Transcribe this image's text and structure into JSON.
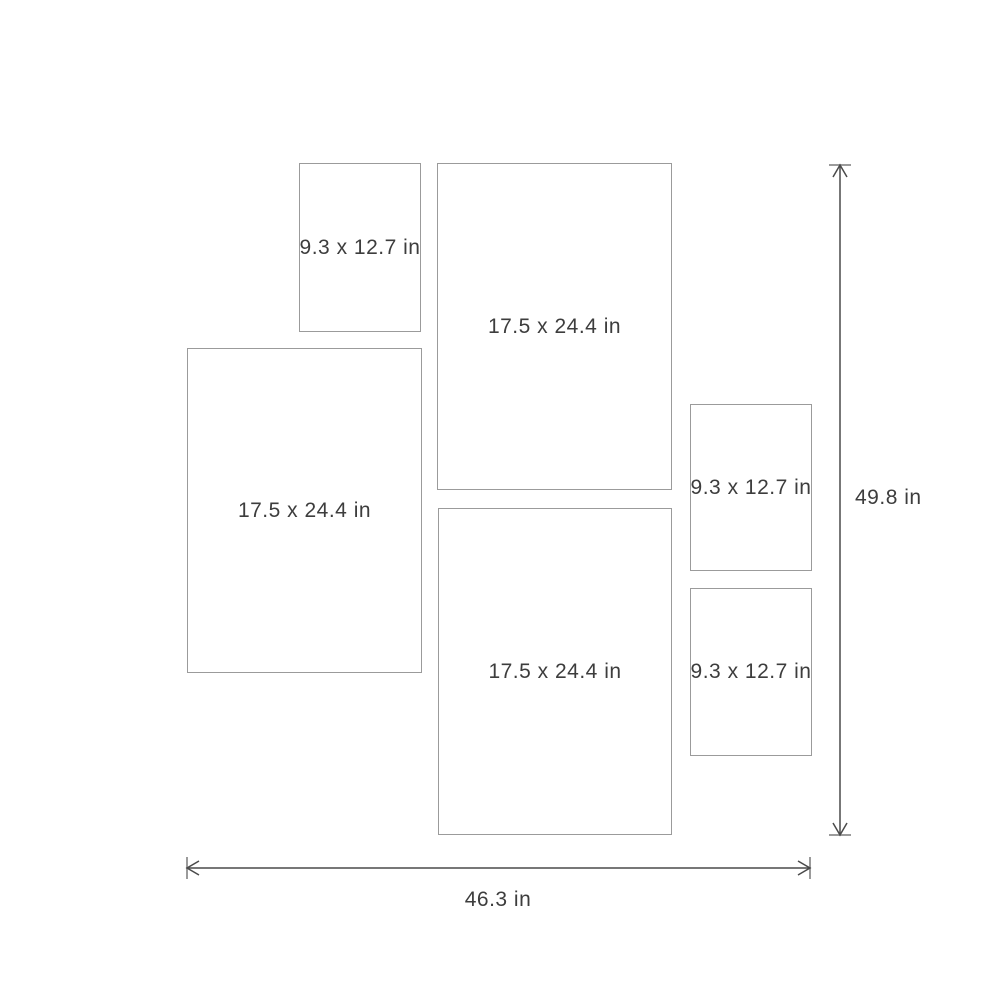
{
  "diagram": {
    "title": "frame-set-size-guide"
  },
  "frames": [
    {
      "id": "frame-small-top",
      "label": "9.3 x 12.7 in"
    },
    {
      "id": "frame-large-top-middle",
      "label": "17.5 x 24.4 in"
    },
    {
      "id": "frame-large-left",
      "label": "17.5 x 24.4 in"
    },
    {
      "id": "frame-large-bottom-middle",
      "label": "17.5 x 24.4 in"
    },
    {
      "id": "frame-small-right-upper",
      "label": "9.3 x 12.7 in"
    },
    {
      "id": "frame-small-right-lower",
      "label": "9.3 x 12.7 in"
    }
  ],
  "dimensions": {
    "width_label": "46.3 in",
    "height_label": "49.8 in"
  },
  "colors": {
    "frame_border": "#9b9b9b",
    "label_text": "#3d3d3d",
    "arrow": "#4a4a4a",
    "tick": "#9b9b9b",
    "bg": "#ffffff"
  }
}
